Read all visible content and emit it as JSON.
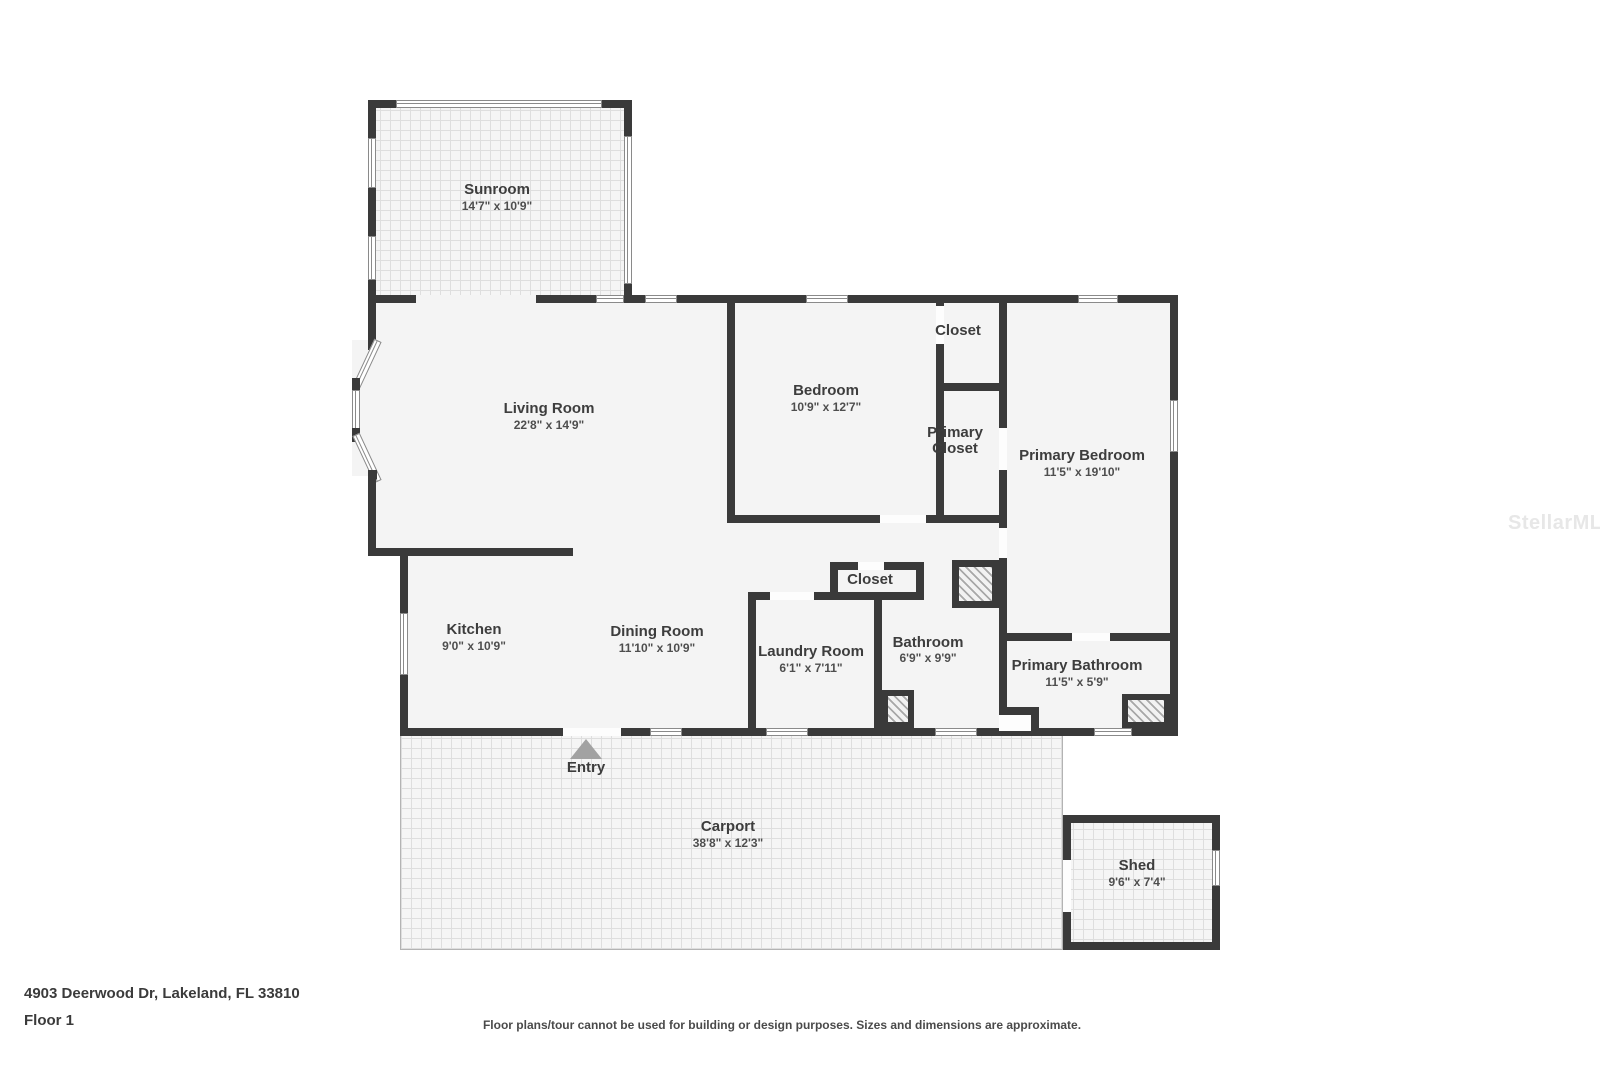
{
  "meta": {
    "address": "4903 Deerwood Dr, Lakeland, FL 33810",
    "floor_label": "Floor 1",
    "disclaimer": "Floor plans/tour cannot be used for building or design purposes. Sizes and dimensions are approximate.",
    "watermark": "StellarMLS"
  },
  "colors": {
    "wall": "#3a3a3a",
    "floor": "#f4f4f4",
    "label": "#3d3d3d"
  },
  "rooms": {
    "sunroom": {
      "name": "Sunroom",
      "dims": "14'7\" x 10'9\""
    },
    "living_room": {
      "name": "Living Room",
      "dims": "22'8\" x 14'9\""
    },
    "bedroom": {
      "name": "Bedroom",
      "dims": "10'9\" x 12'7\""
    },
    "closet_bedroom": {
      "name": "Closet"
    },
    "primary_closet": {
      "name": "Primary Closet"
    },
    "primary_bedroom": {
      "name": "Primary Bedroom",
      "dims": "11'5\" x 19'10\""
    },
    "kitchen": {
      "name": "Kitchen",
      "dims": "9'0\" x 10'9\""
    },
    "dining_room": {
      "name": "Dining Room",
      "dims": "11'10\" x 10'9\""
    },
    "laundry_room": {
      "name": "Laundry Room",
      "dims": "6'1\" x 7'11\""
    },
    "closet_hall": {
      "name": "Closet"
    },
    "bathroom": {
      "name": "Bathroom",
      "dims": "6'9\" x 9'9\""
    },
    "primary_bathroom": {
      "name": "Primary Bathroom",
      "dims": "11'5\" x 5'9\""
    },
    "entry": {
      "name": "Entry"
    },
    "carport": {
      "name": "Carport",
      "dims": "38'8\" x 12'3\""
    },
    "shed": {
      "name": "Shed",
      "dims": "9'6\" x 7'4\""
    }
  }
}
